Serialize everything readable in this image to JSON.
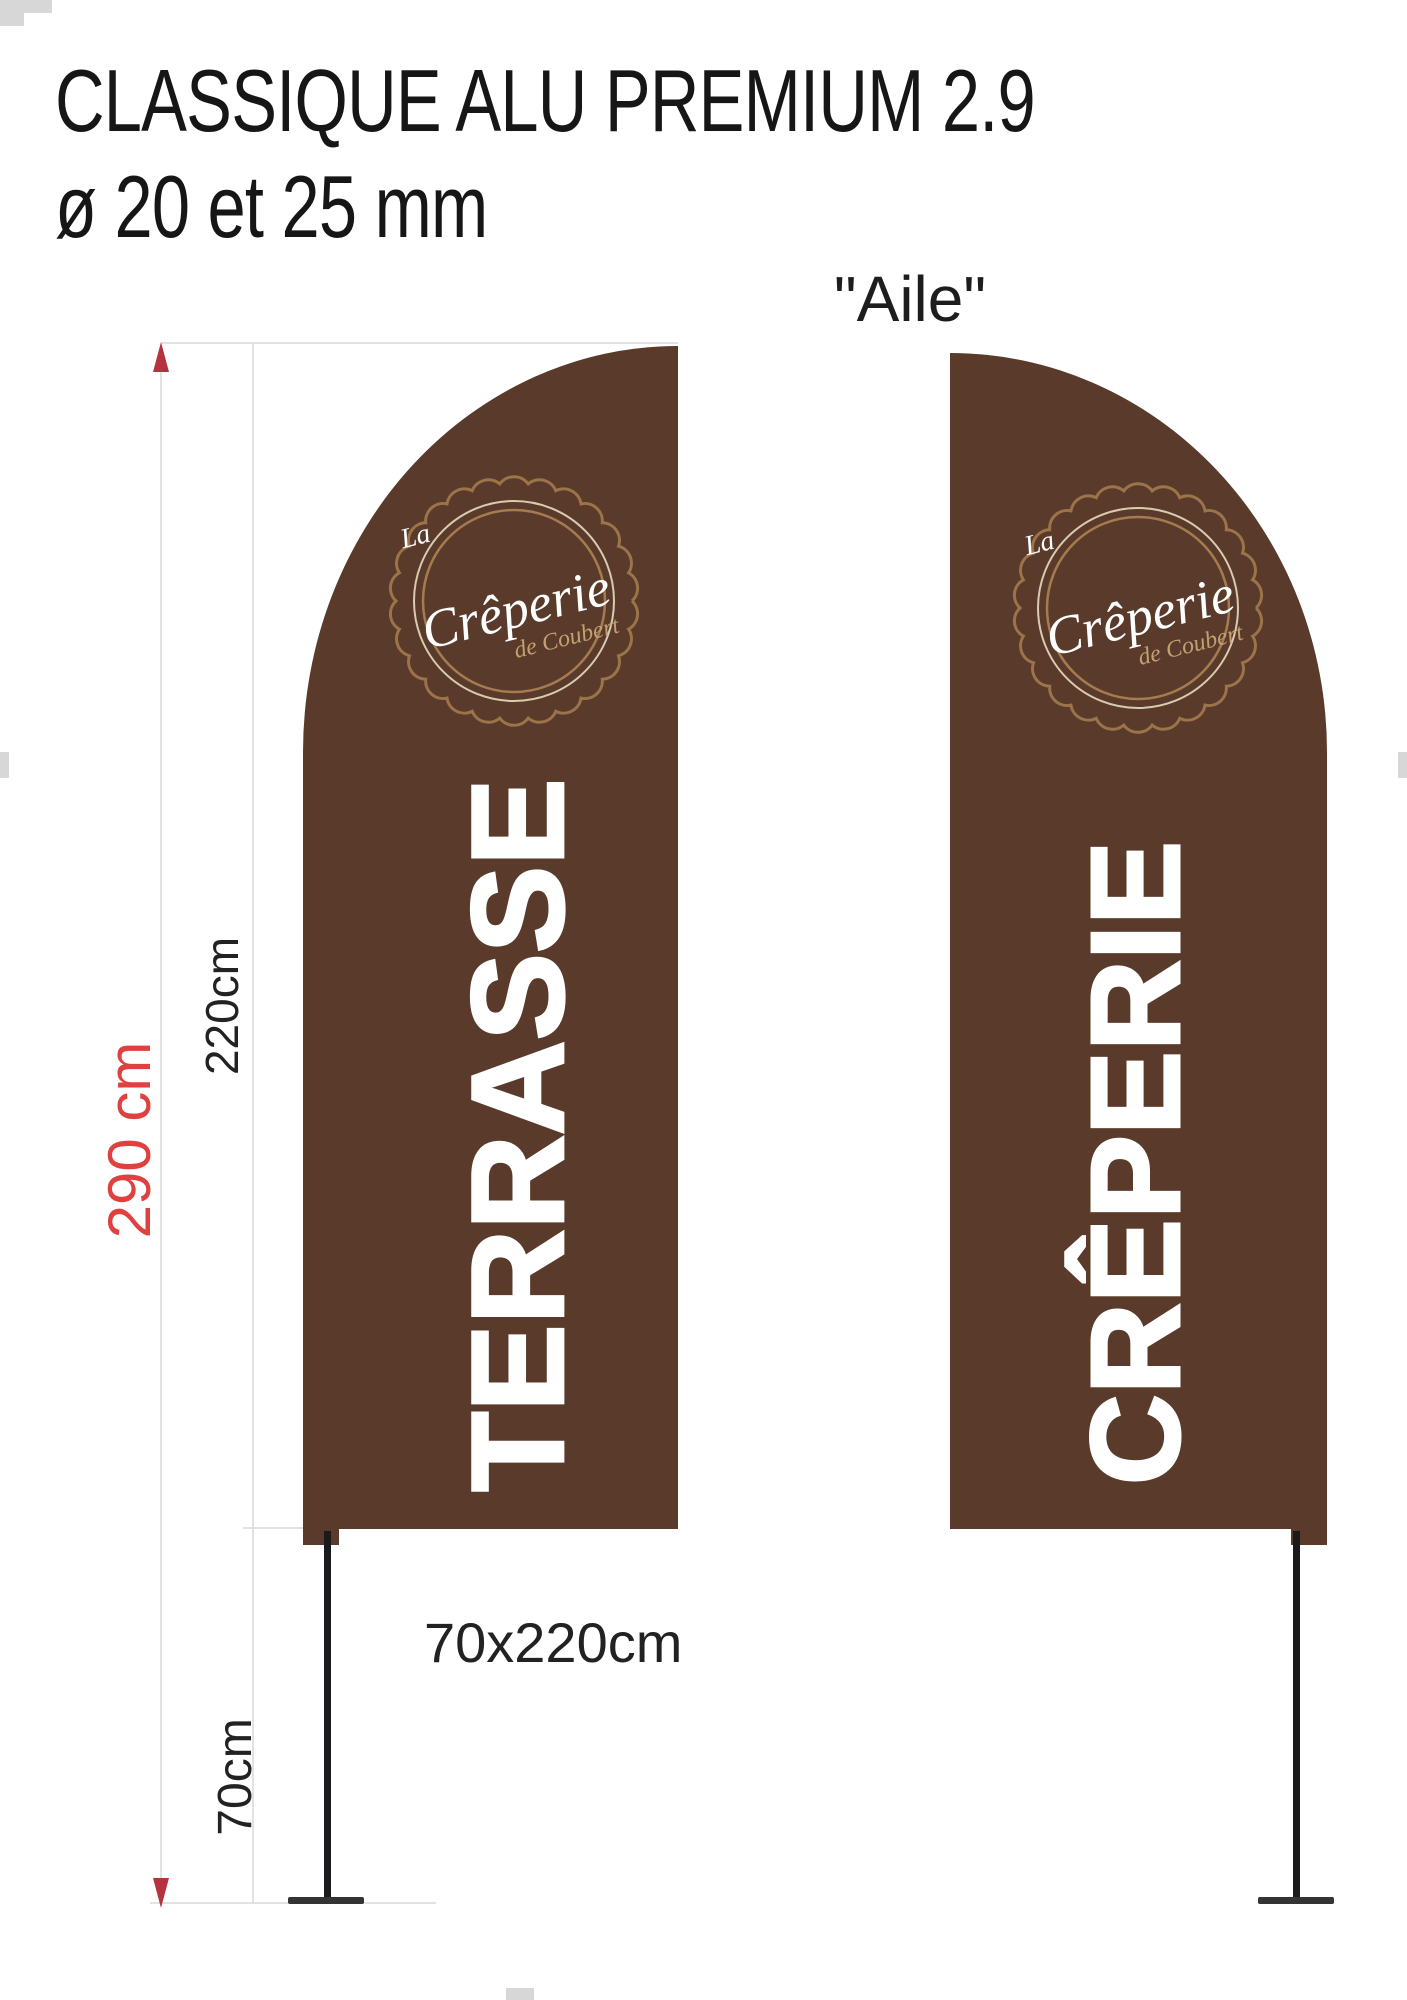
{
  "page": {
    "title_line1": "CLASSIQUE ALU PREMIUM 2.9",
    "title_line2": "ø 20 et 25 mm",
    "variant_label": "\"Aile\""
  },
  "dimensions": {
    "total_height_label": "290 cm",
    "flag_height_label": "220cm",
    "pole_bottom_label": "70cm",
    "flag_size_label": "70x220cm"
  },
  "flags": {
    "left_text": "TERRASSE",
    "right_text": "CRÊPERIE"
  },
  "logo": {
    "prefix": "La",
    "name": "Crêperie",
    "suffix": "de Coubert"
  },
  "colors": {
    "flag_brown": "#5a3b2b",
    "logo_tan": "#9c744a",
    "logo_ring_light": "#d9cbb0",
    "logo_ring_tan": "#a57c50",
    "logo_sub_tan": "#c3a071",
    "flag_text_white": "#ffffff",
    "pole_black": "#1a1a1c",
    "base_gray": "#333333",
    "dim_line_gray": "#d9d9d9",
    "arrow_red": "#b5333f",
    "label_red": "#df4040",
    "label_black": "#222222"
  }
}
